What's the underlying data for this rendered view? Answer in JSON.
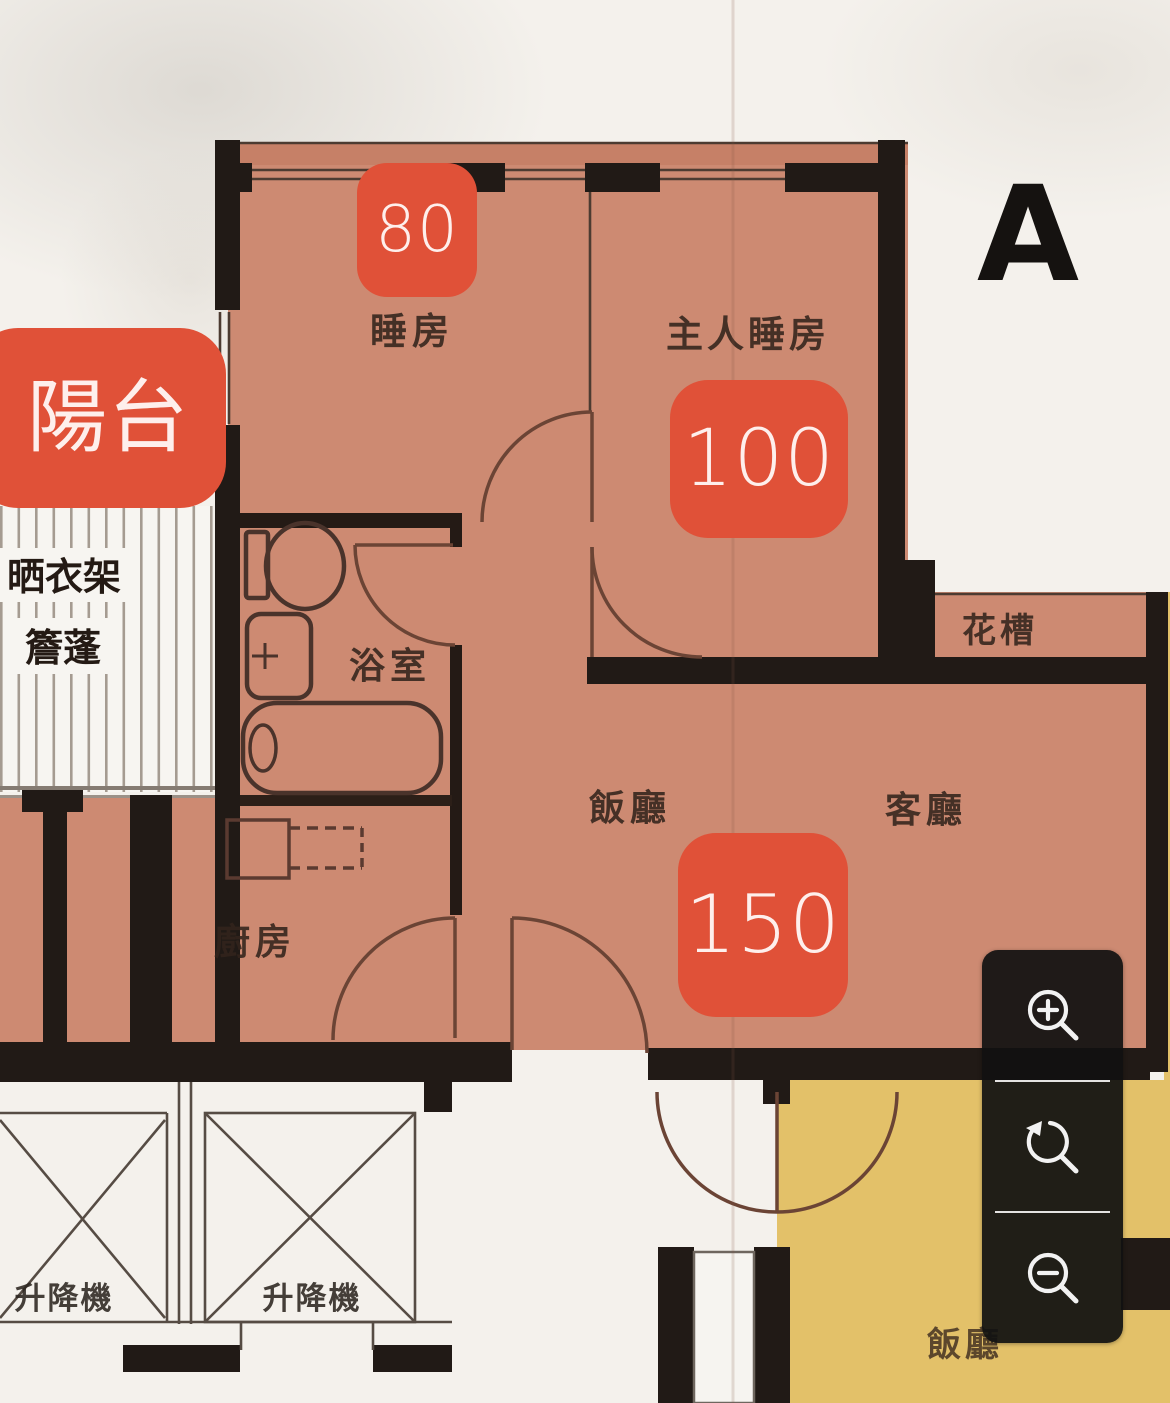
{
  "unit": {
    "letter": "A"
  },
  "rooms": {
    "bedroom": "睡房",
    "master_bedroom": "主人睡房",
    "bathroom": "浴室",
    "kitchen": "廚房",
    "dining": "飯廳",
    "living": "客廳",
    "planter": "花槽",
    "drying_rack": "晒衣架",
    "canopy": "簷蓬",
    "lift_left": "升降機",
    "lift_right": "升降機",
    "neighbor_dining": "飯廳"
  },
  "overlays": {
    "balcony_label": "陽台",
    "bedroom_value": "80",
    "master_value": "100",
    "living_value": "150"
  },
  "controls": {
    "zoom_in": "zoom-in",
    "reset_view": "reset-view",
    "zoom_out": "zoom-out"
  },
  "colors": {
    "floor": "#cd8a72",
    "highlight_chip": "#e05138",
    "neighbor_floor": "#e3c169",
    "wall": "#211a16",
    "panel": "#111111"
  }
}
